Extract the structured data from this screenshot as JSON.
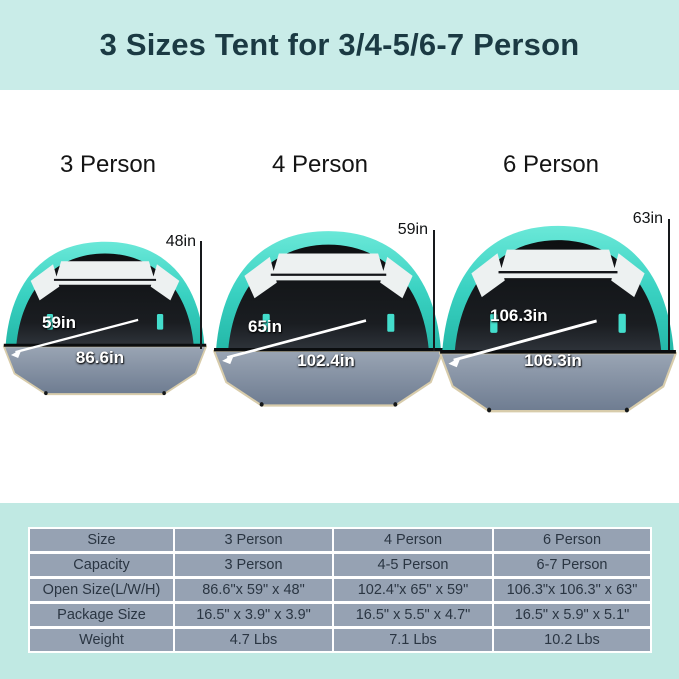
{
  "header": {
    "title": "3 Sizes Tent for 3/4-5/6-7 Person"
  },
  "tents": [
    {
      "title": "3 Person",
      "height": "48in",
      "depth": "59in",
      "width": "86.6in"
    },
    {
      "title": "4 Person",
      "height": "59in",
      "depth": "65in",
      "width": "102.4in"
    },
    {
      "title": "6 Person",
      "height": "63in",
      "depth": "106.3in",
      "width": "106.3in"
    }
  ],
  "spec_table": {
    "rows": [
      {
        "label": "Size",
        "values": [
          "3 Person",
          "4 Person",
          "6 Person"
        ]
      },
      {
        "label": "Capacity",
        "values": [
          "3 Person",
          "4-5 Person",
          "6-7 Person"
        ]
      },
      {
        "label": "Open Size(L/W/H)",
        "values": [
          "86.6\"x 59\" x 48\"",
          "102.4\"x 65\" x 59\"",
          "106.3\"x 106.3\" x 63\""
        ]
      },
      {
        "label": "Package Size",
        "values": [
          "16.5\" x 3.9\" x 3.9\"",
          "16.5\" x 5.5\" x 4.7\"",
          "16.5\" x 5.9\" x 5.1\""
        ]
      },
      {
        "label": "Weight",
        "values": [
          "4.7 Lbs",
          "7.1 Lbs",
          "10.2 Lbs"
        ]
      }
    ]
  },
  "colors": {
    "header_bg": "#c9ece8",
    "header_text": "#1b3a43",
    "section_bg": "#c0e9e3",
    "canopy_teal": "#35cfc0",
    "tent_interior": "#16181b",
    "floor_gray": "#8493a6",
    "floor_edge_tan": "#d8ccab",
    "table_cell_bg": "#96a2b3",
    "table_text": "#2a3542"
  }
}
